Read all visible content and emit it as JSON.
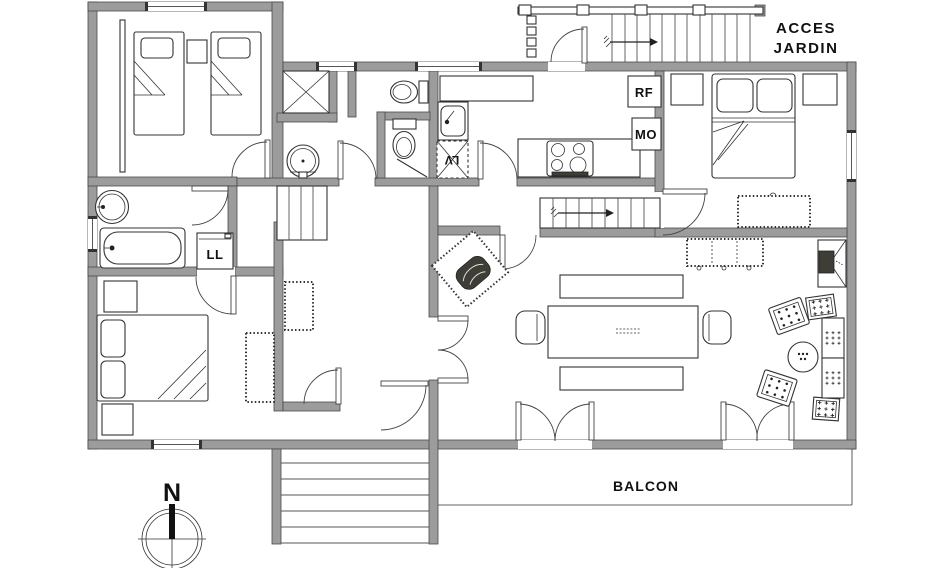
{
  "labels": {
    "acces": "ACCES",
    "jardin": "JARDIN",
    "balcon": "BALCON",
    "rf": "RF",
    "mo": "MO",
    "lv": "LV",
    "ll": "LL",
    "north": "N"
  },
  "colors": {
    "wall": "#9c9c9c",
    "wall_edge": "#4a4a4a",
    "line": "#333333",
    "dark": "#3f3e36"
  }
}
